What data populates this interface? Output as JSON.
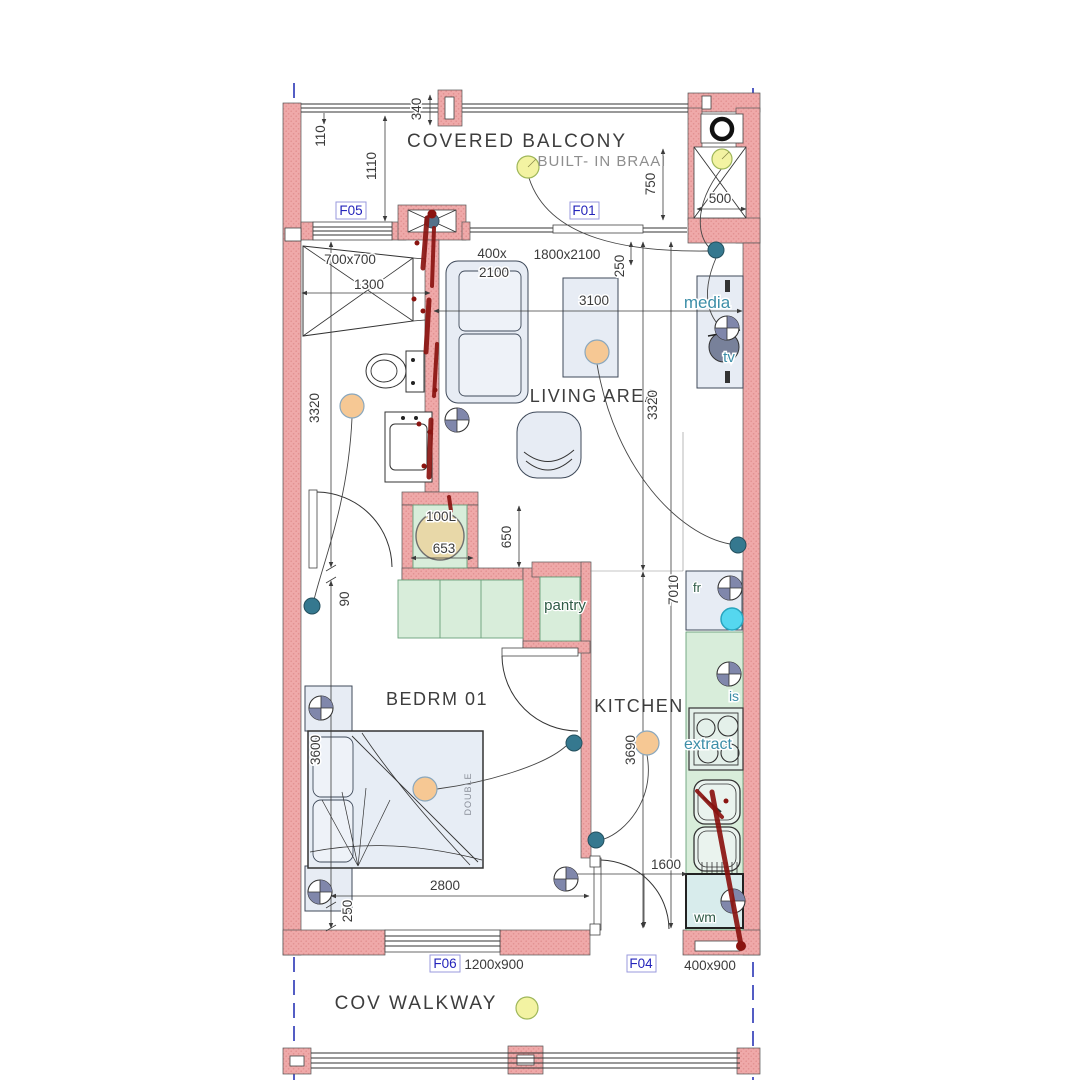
{
  "colors": {
    "wall_pink": "#efa9a9",
    "wall_dot": "#e29090",
    "furniture_fill": "#e7ecf4",
    "cabinet_green": "#d8edda",
    "appliance_cyan": "#d8ecec",
    "label_blue": "#2424bb",
    "teal_text": "#3d8ea8",
    "green_text": "#2f5b47",
    "dim_text": "#3b3b3b",
    "boundary_blue": "#2a35b5",
    "light_yellow": "#f3f3a2",
    "light_orange": "#f6c894",
    "switch_teal": "#35788f",
    "socket_fill": "#8087ab",
    "marker_red": "#8a1410",
    "geyser_tan": "#e8d8a8",
    "isolator_cyan": "#55d7ef"
  },
  "rooms": {
    "balcony": "COVERED BALCONY",
    "braai": "BUILT- IN BRAAI",
    "living": "LIVING AREA",
    "bedroom": "BEDRM 01",
    "kitchen": "KITCHEN",
    "walkway": "COV WALKWAY"
  },
  "fixtures": {
    "geyser": "100L",
    "pantry": "pantry",
    "fridge": "fr",
    "isolator": "is",
    "extractor": "extract",
    "washing_machine": "wm",
    "media": "media",
    "tv": "tv",
    "bed": "DOUBLE"
  },
  "openings": {
    "f05": "F05",
    "f01": "F01",
    "f06": "F06",
    "f04": "F04",
    "f06_size": "1200x900",
    "f04_size": "400x900"
  },
  "dims": {
    "d340": "340",
    "d110": "110",
    "d1110": "1110",
    "d750": "750",
    "d500": "500",
    "shower": "700x700",
    "d1300": "1300",
    "d400x": "400x",
    "d2100": "2100",
    "door_f01": "1800x2100",
    "d250_top": "250",
    "d3100": "3100",
    "d3320_left": "3320",
    "d3320_right": "3320",
    "d650": "650",
    "d653": "653",
    "d90": "90",
    "d7010": "7010",
    "d3690": "3690",
    "d3600": "3600",
    "d2800": "2800",
    "d250_bottom": "250",
    "d1600": "1600"
  }
}
